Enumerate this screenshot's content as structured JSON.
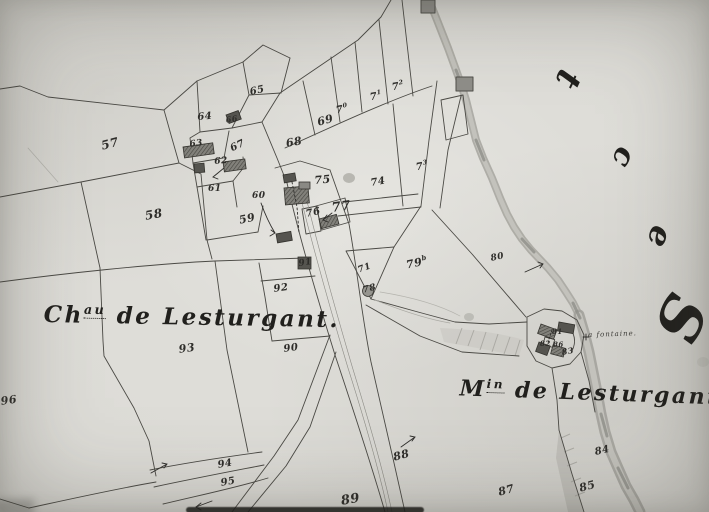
{
  "map": {
    "kind": "scanned cadastral plan (hand-drawn, monochrome)",
    "place_labels": {
      "chateau": {
        "prefix": "Ch",
        "sup": "au",
        "rest": " de Lesturgant",
        "period": "."
      },
      "moulin": {
        "prefix": "M",
        "sup": "in",
        "rest": " de Lesturgant"
      },
      "fontaine": {
        "text": "a fontaine."
      }
    },
    "margin_letters": [
      {
        "ch": "t",
        "x": 560,
        "y": 62,
        "s": 34,
        "r": 115
      },
      {
        "ch": "c",
        "x": 614,
        "y": 142,
        "s": 30,
        "r": 115
      },
      {
        "ch": "e",
        "x": 650,
        "y": 221,
        "s": 32,
        "r": 110
      },
      {
        "ch": "S",
        "x": 658,
        "y": 288,
        "s": 60,
        "r": 115
      }
    ],
    "parcel_numbers": [
      {
        "t": "57",
        "x": 100,
        "y": 140,
        "r": -14,
        "s": 12
      },
      {
        "t": "58",
        "x": 144,
        "y": 210,
        "r": -10,
        "s": 12
      },
      {
        "t": "59",
        "x": 238,
        "y": 215,
        "r": -12,
        "s": 11
      },
      {
        "t": "60",
        "x": 252,
        "y": 192,
        "r": 0,
        "s": 9
      },
      {
        "t": "61",
        "x": 208,
        "y": 185,
        "r": 0,
        "s": 9
      },
      {
        "t": "62",
        "x": 214,
        "y": 158,
        "r": -5,
        "s": 9
      },
      {
        "t": "63",
        "x": 189,
        "y": 141,
        "r": -8,
        "s": 9
      },
      {
        "t": "64",
        "x": 197,
        "y": 113,
        "r": -5,
        "s": 10
      },
      {
        "t": "65",
        "x": 249,
        "y": 88,
        "r": -12,
        "s": 10
      },
      {
        "t": "66",
        "x": 225,
        "y": 116,
        "r": -10,
        "s": 8
      },
      {
        "t": "67",
        "x": 229,
        "y": 145,
        "r": -25,
        "s": 10
      },
      {
        "t": "68",
        "x": 285,
        "y": 138,
        "r": -10,
        "s": 11
      },
      {
        "t": "69",
        "x": 316,
        "y": 117,
        "r": -15,
        "s": 11
      },
      {
        "t": "7",
        "sup": "0",
        "x": 335,
        "y": 105,
        "r": -10,
        "s": 10
      },
      {
        "t": "7",
        "sup": "1",
        "x": 369,
        "y": 92,
        "r": -10,
        "s": 10
      },
      {
        "t": "7",
        "sup": "2",
        "x": 391,
        "y": 82,
        "r": -10,
        "s": 10
      },
      {
        "t": "7",
        "sup": "3",
        "x": 415,
        "y": 162,
        "r": -10,
        "s": 10
      },
      {
        "t": "74",
        "x": 370,
        "y": 179,
        "r": -10,
        "s": 10
      },
      {
        "t": "75",
        "x": 314,
        "y": 175,
        "r": -5,
        "s": 11
      },
      {
        "t": "76",
        "x": 305,
        "y": 210,
        "r": -12,
        "s": 10
      },
      {
        "t": "77",
        "x": 331,
        "y": 202,
        "r": -8,
        "s": 13
      },
      {
        "t": "71",
        "x": 357,
        "y": 267,
        "r": -20,
        "s": 9
      },
      {
        "t": "78",
        "x": 362,
        "y": 287,
        "r": -15,
        "s": 9
      },
      {
        "t": "79",
        "sup": "b",
        "x": 405,
        "y": 259,
        "r": -12,
        "s": 11
      },
      {
        "t": "80",
        "x": 490,
        "y": 255,
        "r": -12,
        "s": 9
      },
      {
        "t": "81",
        "x": 552,
        "y": 328,
        "r": 0,
        "s": 7
      },
      {
        "t": "82",
        "x": 540,
        "y": 340,
        "r": 0,
        "s": 7
      },
      {
        "t": "86",
        "x": 553,
        "y": 341,
        "r": 0,
        "s": 7
      },
      {
        "t": "83",
        "x": 561,
        "y": 348,
        "r": -10,
        "s": 8
      },
      {
        "t": "84",
        "x": 594,
        "y": 448,
        "r": -12,
        "s": 10
      },
      {
        "t": "85",
        "x": 578,
        "y": 483,
        "r": -15,
        "s": 11
      },
      {
        "t": "87",
        "x": 497,
        "y": 487,
        "r": -15,
        "s": 11
      },
      {
        "t": "88",
        "x": 392,
        "y": 452,
        "r": -15,
        "s": 11
      },
      {
        "t": "89",
        "x": 340,
        "y": 495,
        "r": -10,
        "s": 13
      },
      {
        "t": "90",
        "x": 283,
        "y": 345,
        "r": -8,
        "s": 10
      },
      {
        "t": "91",
        "x": 298,
        "y": 260,
        "r": -8,
        "s": 9
      },
      {
        "t": "92",
        "x": 273,
        "y": 285,
        "r": -8,
        "s": 10
      },
      {
        "t": "93",
        "x": 178,
        "y": 344,
        "r": -8,
        "s": 11
      },
      {
        "t": "94",
        "x": 217,
        "y": 461,
        "r": -10,
        "s": 10
      },
      {
        "t": "95",
        "x": 220,
        "y": 479,
        "r": -10,
        "s": 10
      },
      {
        "t": "96",
        "x": 0,
        "y": 396,
        "r": -8,
        "s": 11
      }
    ],
    "colors": {
      "paper": "#d6d5d0",
      "paper_light": "#deddd8",
      "ink": "#2e2d2a",
      "line": "#4a4944",
      "stream_edge": "#9e9d97",
      "stream_fill": "#c3c2bc",
      "building_dark": "#55544f",
      "building_mid": "#8a8984",
      "wash": "#bfbeb8",
      "scan_edge": "#141412"
    }
  }
}
